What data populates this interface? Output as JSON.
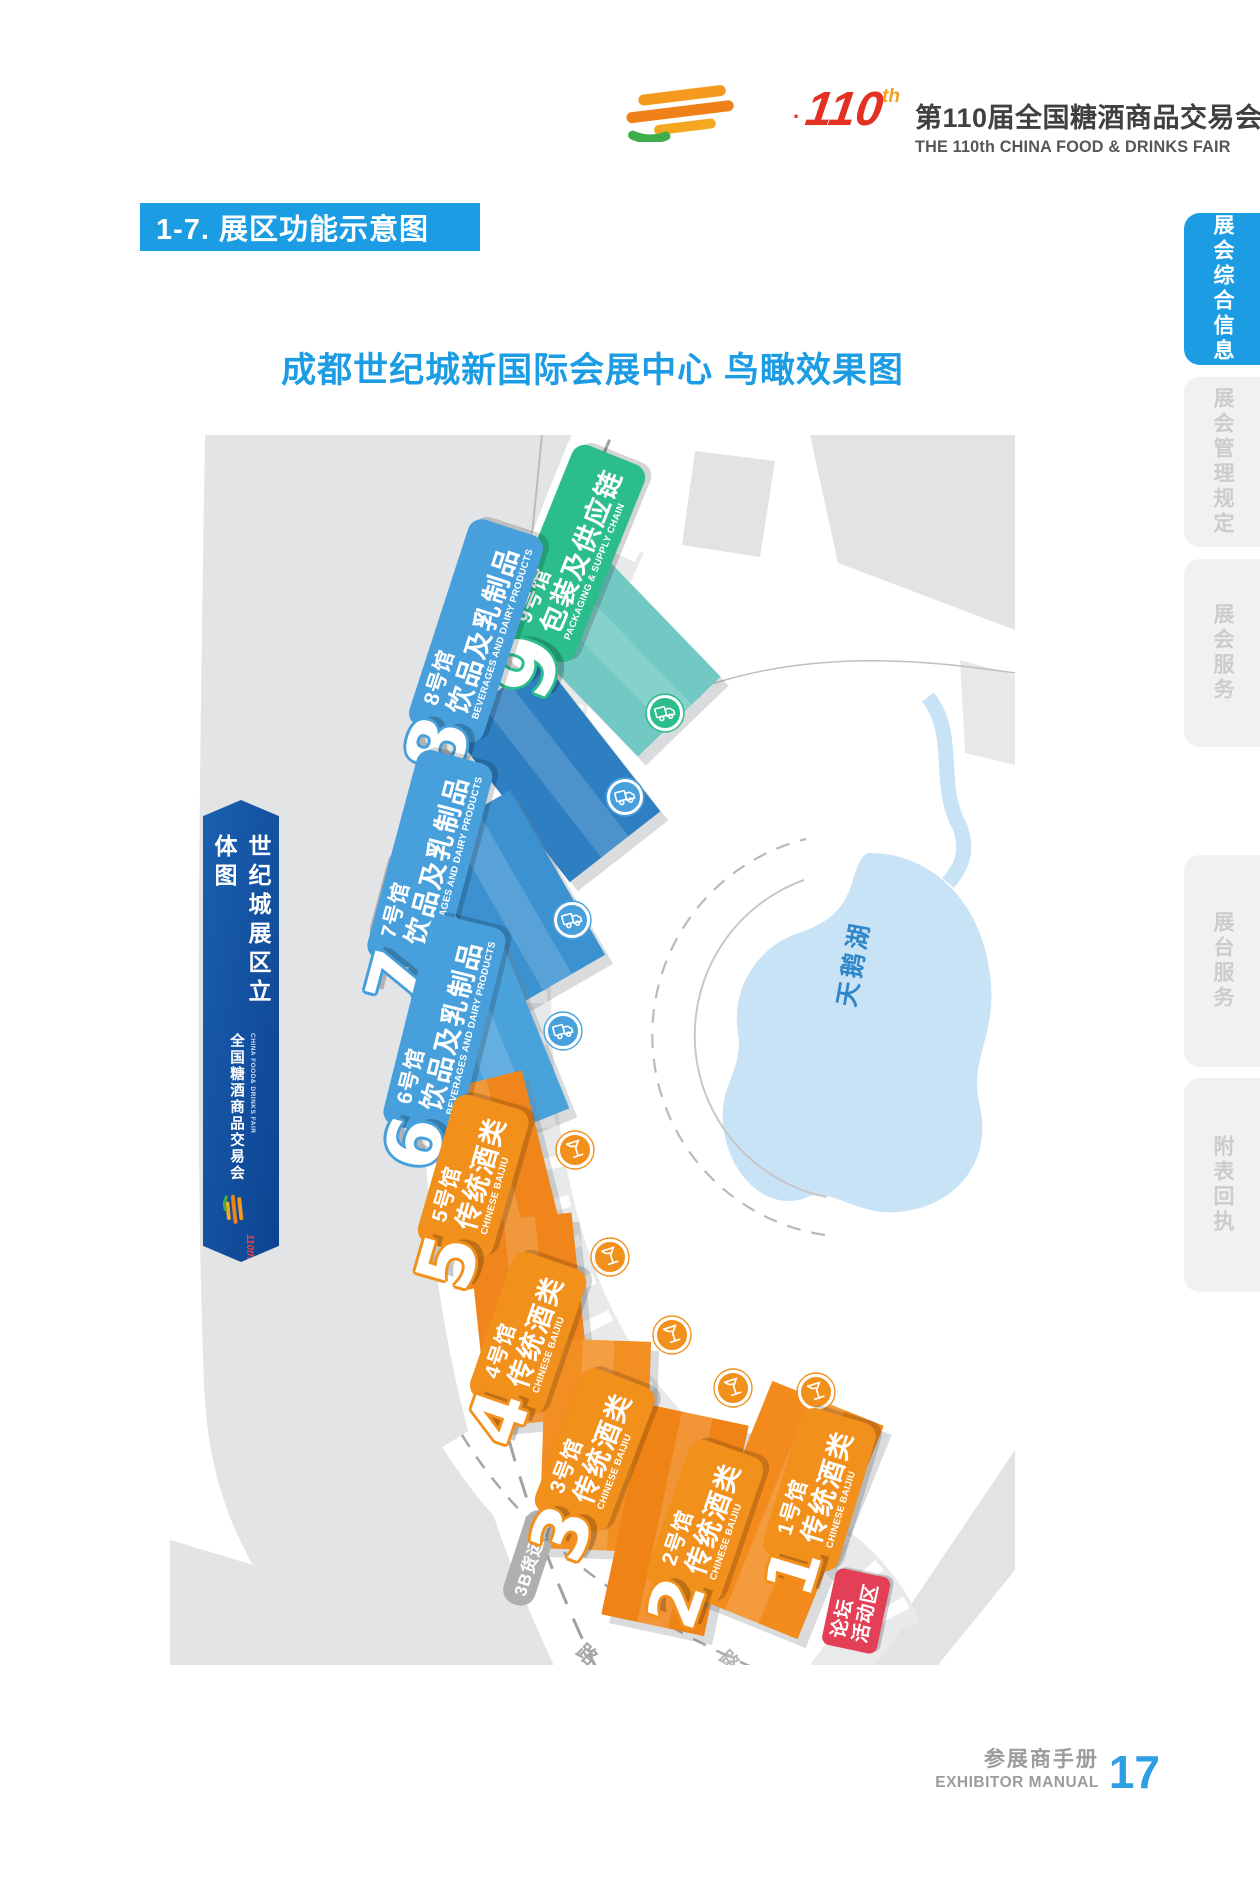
{
  "header": {
    "logo_dot": "·",
    "logo_no": "110",
    "logo_no_suffix": "th",
    "title_cn": "第110届全国糖酒商品交易会",
    "title_en": "THE 110th CHINA FOOD & DRINKS FAIR"
  },
  "section_title": "1-7. 展区功能示意图",
  "map_title": "成都世纪城新国际会展中心 鸟瞰效果图",
  "sidebar_tabs": [
    {
      "label": "展会综合信息",
      "active": true
    },
    {
      "label": "展会管理规定",
      "active": false
    },
    {
      "label": "展会服务",
      "active": false
    },
    {
      "label": "展台服务",
      "active": false
    },
    {
      "label": "附表回执",
      "active": false
    }
  ],
  "side_banner": {
    "title": "世纪城展区立体图",
    "fair_cn": "全国糖酒商品交易会",
    "fair_en": "CHINA FOOD& DRINKS FAIR",
    "logo_no": "110th"
  },
  "map": {
    "lake_label": "天鹅湖",
    "gates": [
      "6B货运口",
      "3B货运口"
    ],
    "forum_lines": [
      "论坛",
      "活动区"
    ],
    "road_fragments": [
      "路",
      "路"
    ],
    "groups": {
      "baijiu": {
        "color": "#F2901C",
        "building": "#F0861B"
      },
      "beverages": {
        "color": "#47A0DC",
        "building": "#3E93D1"
      },
      "packaging": {
        "color": "#2BBD8B",
        "building": "#72C9C4"
      }
    },
    "halls": [
      {
        "num": "9",
        "label": "9号馆",
        "cat_cn": "包装及供应链",
        "cat_en": "PACKAGING & SUPPLY CHAIN",
        "group": "packaging",
        "icon": "truck-icon"
      },
      {
        "num": "8",
        "label": "8号馆",
        "cat_cn": "饮品及乳制品",
        "cat_en": "BEVERAGES AND DAIRY PRODUCTS",
        "group": "beverages",
        "icon": "truck-icon"
      },
      {
        "num": "7",
        "label": "7号馆",
        "cat_cn": "饮品及乳制品",
        "cat_en": "BEVERAGES AND DAIRY PRODUCTS",
        "group": "beverages",
        "icon": "truck-icon"
      },
      {
        "num": "6",
        "label": "6号馆",
        "cat_cn": "饮品及乳制品",
        "cat_en": "BEVERAGES AND DAIRY PRODUCTS",
        "group": "beverages",
        "icon": "truck-icon"
      },
      {
        "num": "5",
        "label": "5号馆",
        "cat_cn": "传统酒类",
        "cat_en": "CHINESE BAIJIU",
        "group": "baijiu",
        "icon": "wine-glass-icon"
      },
      {
        "num": "4",
        "label": "4号馆",
        "cat_cn": "传统酒类",
        "cat_en": "CHINESE BAIJIU",
        "group": "baijiu",
        "icon": "wine-glass-icon"
      },
      {
        "num": "3",
        "label": "3号馆",
        "cat_cn": "传统酒类",
        "cat_en": "CHINESE BAIJIU",
        "group": "baijiu",
        "icon": "wine-glass-icon"
      },
      {
        "num": "2",
        "label": "2号馆",
        "cat_cn": "传统酒类",
        "cat_en": "CHINESE BAIJIU",
        "group": "baijiu",
        "icon": "wine-glass-icon"
      },
      {
        "num": "1",
        "label": "1号馆",
        "cat_cn": "传统酒类",
        "cat_en": "CHINESE BAIJIU",
        "group": "baijiu",
        "icon": "wine-glass-icon"
      }
    ]
  },
  "footer": {
    "manual_cn": "参展商手册",
    "manual_en": "EXHIBITOR MANUAL",
    "page_no": "17"
  },
  "colors": {
    "accent": "#1B9CE3",
    "forum_red": "#E34057",
    "land_gray": "#E3E4E5",
    "lake_blue": "#C8E2F6",
    "page_no_blue": "#2D9FE4"
  }
}
